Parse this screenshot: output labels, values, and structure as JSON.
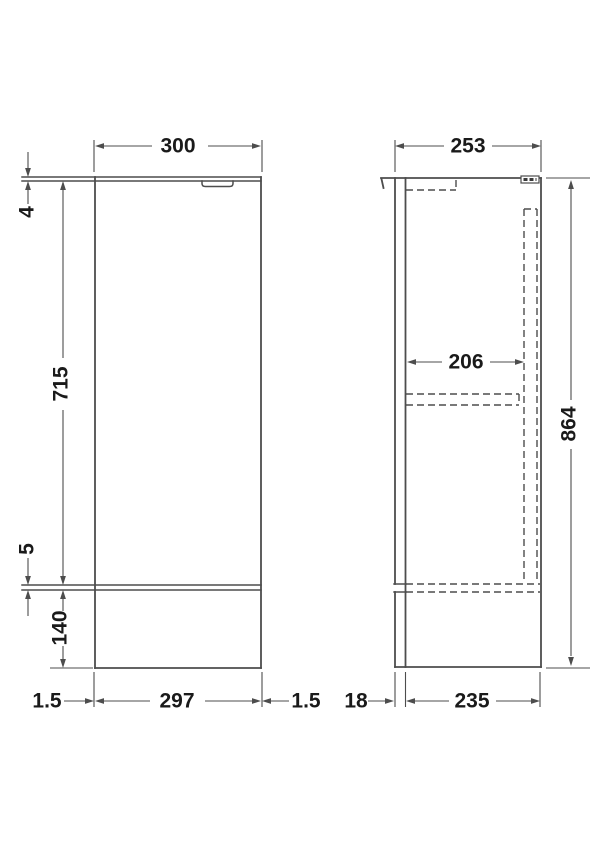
{
  "drawing": {
    "title": "cabinet-unit-dimension-drawing",
    "front_view": {
      "name": "front-elevation",
      "dims": {
        "overall_width": "300",
        "top_panel_thickness": "4",
        "door_height": "715",
        "bottom_gap": "5",
        "plinth_height": "140",
        "left_gap": "1.5",
        "door_width": "297",
        "right_gap": "1.5"
      }
    },
    "side_view": {
      "name": "side-elevation",
      "dims": {
        "overall_depth": "253",
        "internal_depth": "206",
        "overall_height": "864",
        "door_thickness": "18",
        "carcass_depth": "235"
      }
    },
    "colors": {
      "line": "#4d4d4d",
      "hidden_line": "#4d4d4d",
      "text": "#1a1a1a",
      "background": "#ffffff"
    }
  }
}
